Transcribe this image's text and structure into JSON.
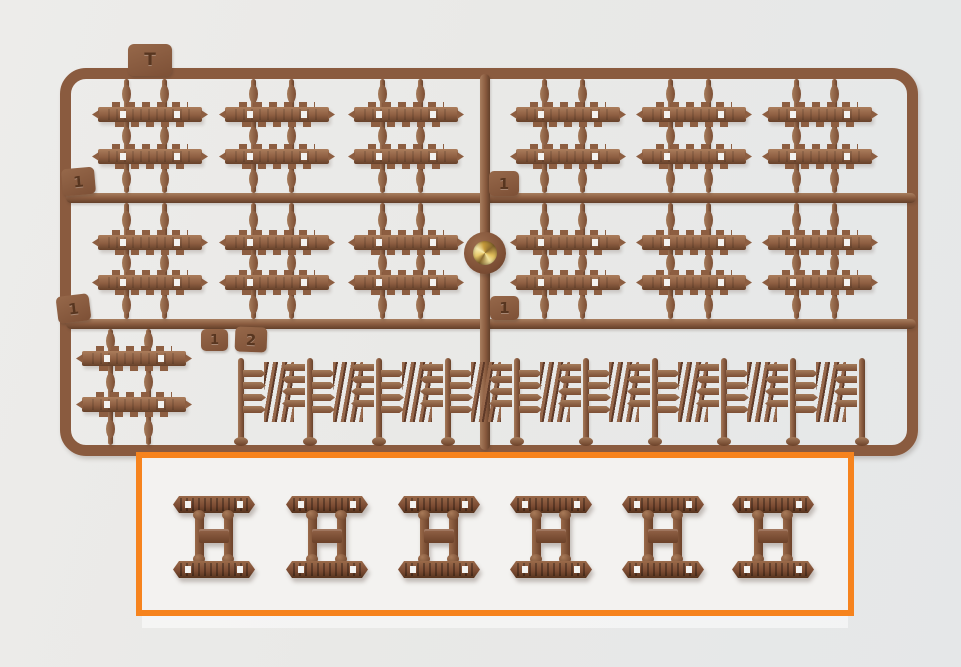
{
  "scene": {
    "subject": "Brown injection-molded plastic sprue of tank track-link parts photographed on a light background, with an orange box highlighting six assembled track-link sets",
    "background_color": "#eae9e7",
    "panel_color": "#f3f2f0"
  },
  "colors": {
    "plastic_main": "#8d5e41",
    "plastic_light": "#ab7d5c",
    "plastic_dark": "#66412a",
    "frame": "#8a5b3f",
    "highlight_border": "#f6831d",
    "gold_insert": "#e3c05c",
    "hole_white": "#f3f2f0"
  },
  "sprue": {
    "tabs": {
      "top_gate": "T",
      "rail1_left": "1",
      "rail1_center": "1",
      "rail2_left": "1",
      "rail2_center": "1",
      "row3_left": "1",
      "row3_right": "2"
    },
    "rows": {
      "top_track_groups": 6,
      "middle_track_groups": 6,
      "bottom_left_track_groups": 1,
      "spring_link_cells": 9
    },
    "links_per_group": 2,
    "center_marker": "round boss with shiny gold metal insert"
  },
  "highlight": {
    "assembled_link_sets": 6,
    "marker": "orange rectangle outline"
  }
}
